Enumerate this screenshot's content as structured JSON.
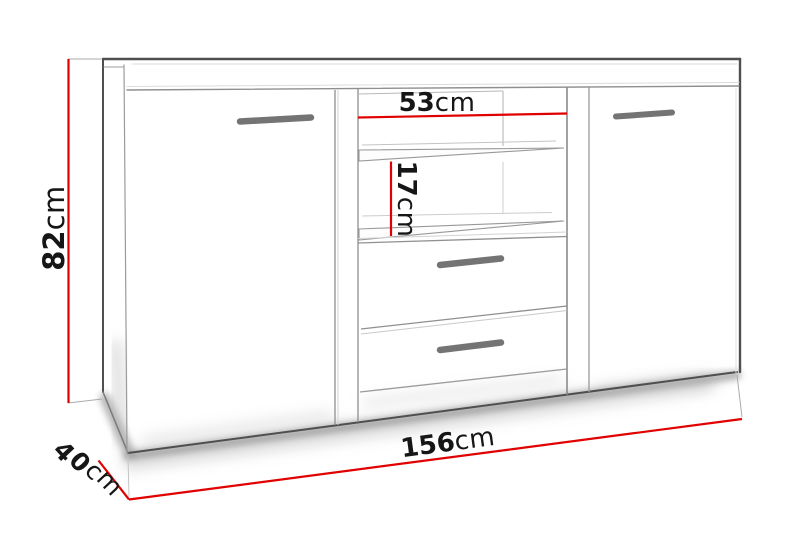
{
  "diagram": {
    "type": "furniture-technical-drawing",
    "subject": "sideboard with two doors, open shelf niche and two drawers",
    "dimensions": {
      "height": {
        "value": "82",
        "unit": "cm"
      },
      "niche_width": {
        "value": "53",
        "unit": "cm"
      },
      "shelf_spacing": {
        "value": "17",
        "unit": "cm"
      },
      "width": {
        "value": "156",
        "unit": "cm"
      },
      "depth": {
        "value": "40",
        "unit": "cm"
      }
    },
    "colors": {
      "dimension_line": "#e10000",
      "label": "#161616",
      "outline": "#4f4f4f",
      "handle": "#747474",
      "background": "#ffffff"
    }
  }
}
